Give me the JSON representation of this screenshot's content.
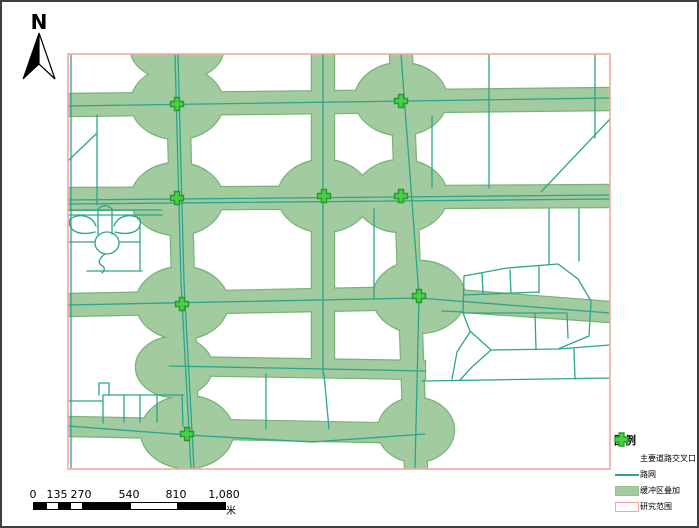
{
  "north_arrow": {
    "label": "N"
  },
  "scale_bar": {
    "labels": [
      "0",
      "135",
      "270",
      "540",
      "810",
      "1,080"
    ],
    "unit": "米"
  },
  "legend": {
    "title": "图例",
    "items": [
      {
        "name": "major-road-intersection",
        "label": "主要道路交叉口"
      },
      {
        "name": "road-network",
        "label": "路网"
      },
      {
        "name": "buffer-overlay",
        "label": "缓冲区叠加"
      },
      {
        "name": "study-area",
        "label": "研究范围"
      }
    ]
  },
  "colors": {
    "buffer_fill": "#a2cba0",
    "buffer_edge": "#77b377",
    "road_line": "#2ba58c",
    "frame_pink": "#f4a6a0",
    "cross_fill": "#44d144",
    "cross_stroke": "#2f9532",
    "scalebar_black": "#000000"
  }
}
